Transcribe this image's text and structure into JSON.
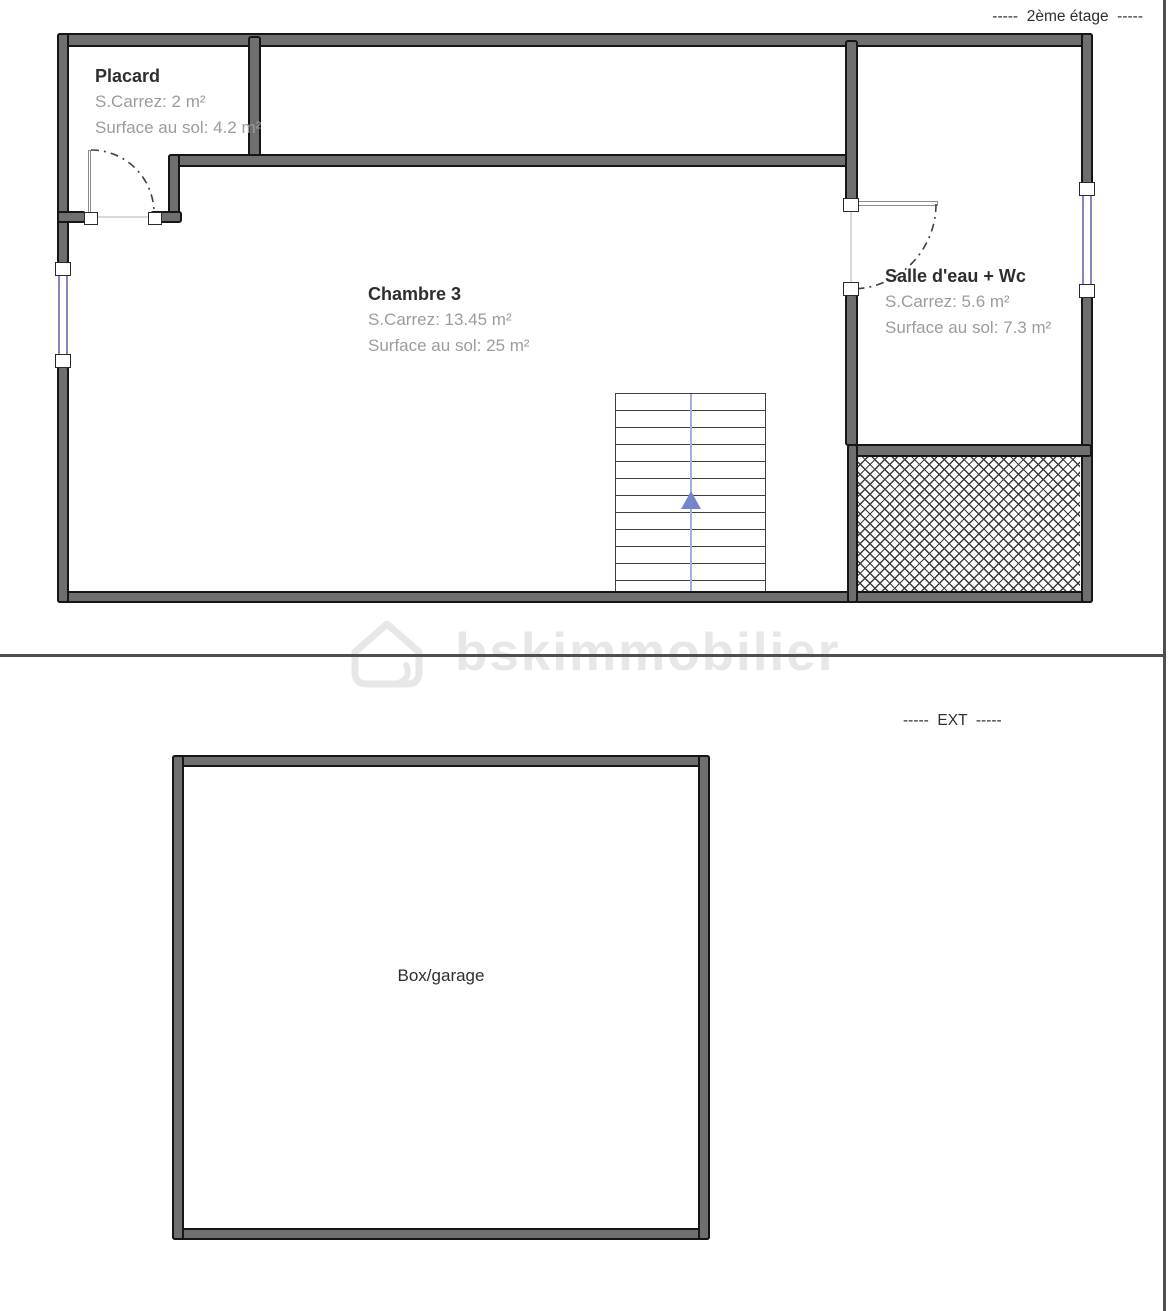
{
  "labels": {
    "floor": "-----  2ème étage  -----",
    "ext": "-----  EXT  -----",
    "watermark": "bskimmobilier"
  },
  "rooms": {
    "placard": {
      "name": "Placard",
      "carrez": "S.Carrez: 2 m²",
      "surface": "Surface au sol: 4.2 m²"
    },
    "chambre3": {
      "name": "Chambre 3",
      "carrez": "S.Carrez: 13.45 m²",
      "surface": "Surface au sol: 25 m²"
    },
    "salle_eau": {
      "name": "Salle d'eau + Wc",
      "carrez": "S.Carrez: 5.6 m²",
      "surface": "Surface au sol: 7.3 m²"
    },
    "box": {
      "name": "Box/garage"
    }
  },
  "colors": {
    "wall_fill": "#6f6f6f",
    "wall_outline": "#161616",
    "window_glass": "#8585c2",
    "door_arc": "#3f3f3f",
    "stair_arrow": "#7585cc",
    "stair_lines": "#3f3f3f",
    "hatch_lines": "#3c3c3c",
    "room_title_text": "#2e2e2e",
    "room_sub_text": "#9c9c9c",
    "divider": "#4f4f4f",
    "watermark_text": "#e7e7e7"
  }
}
